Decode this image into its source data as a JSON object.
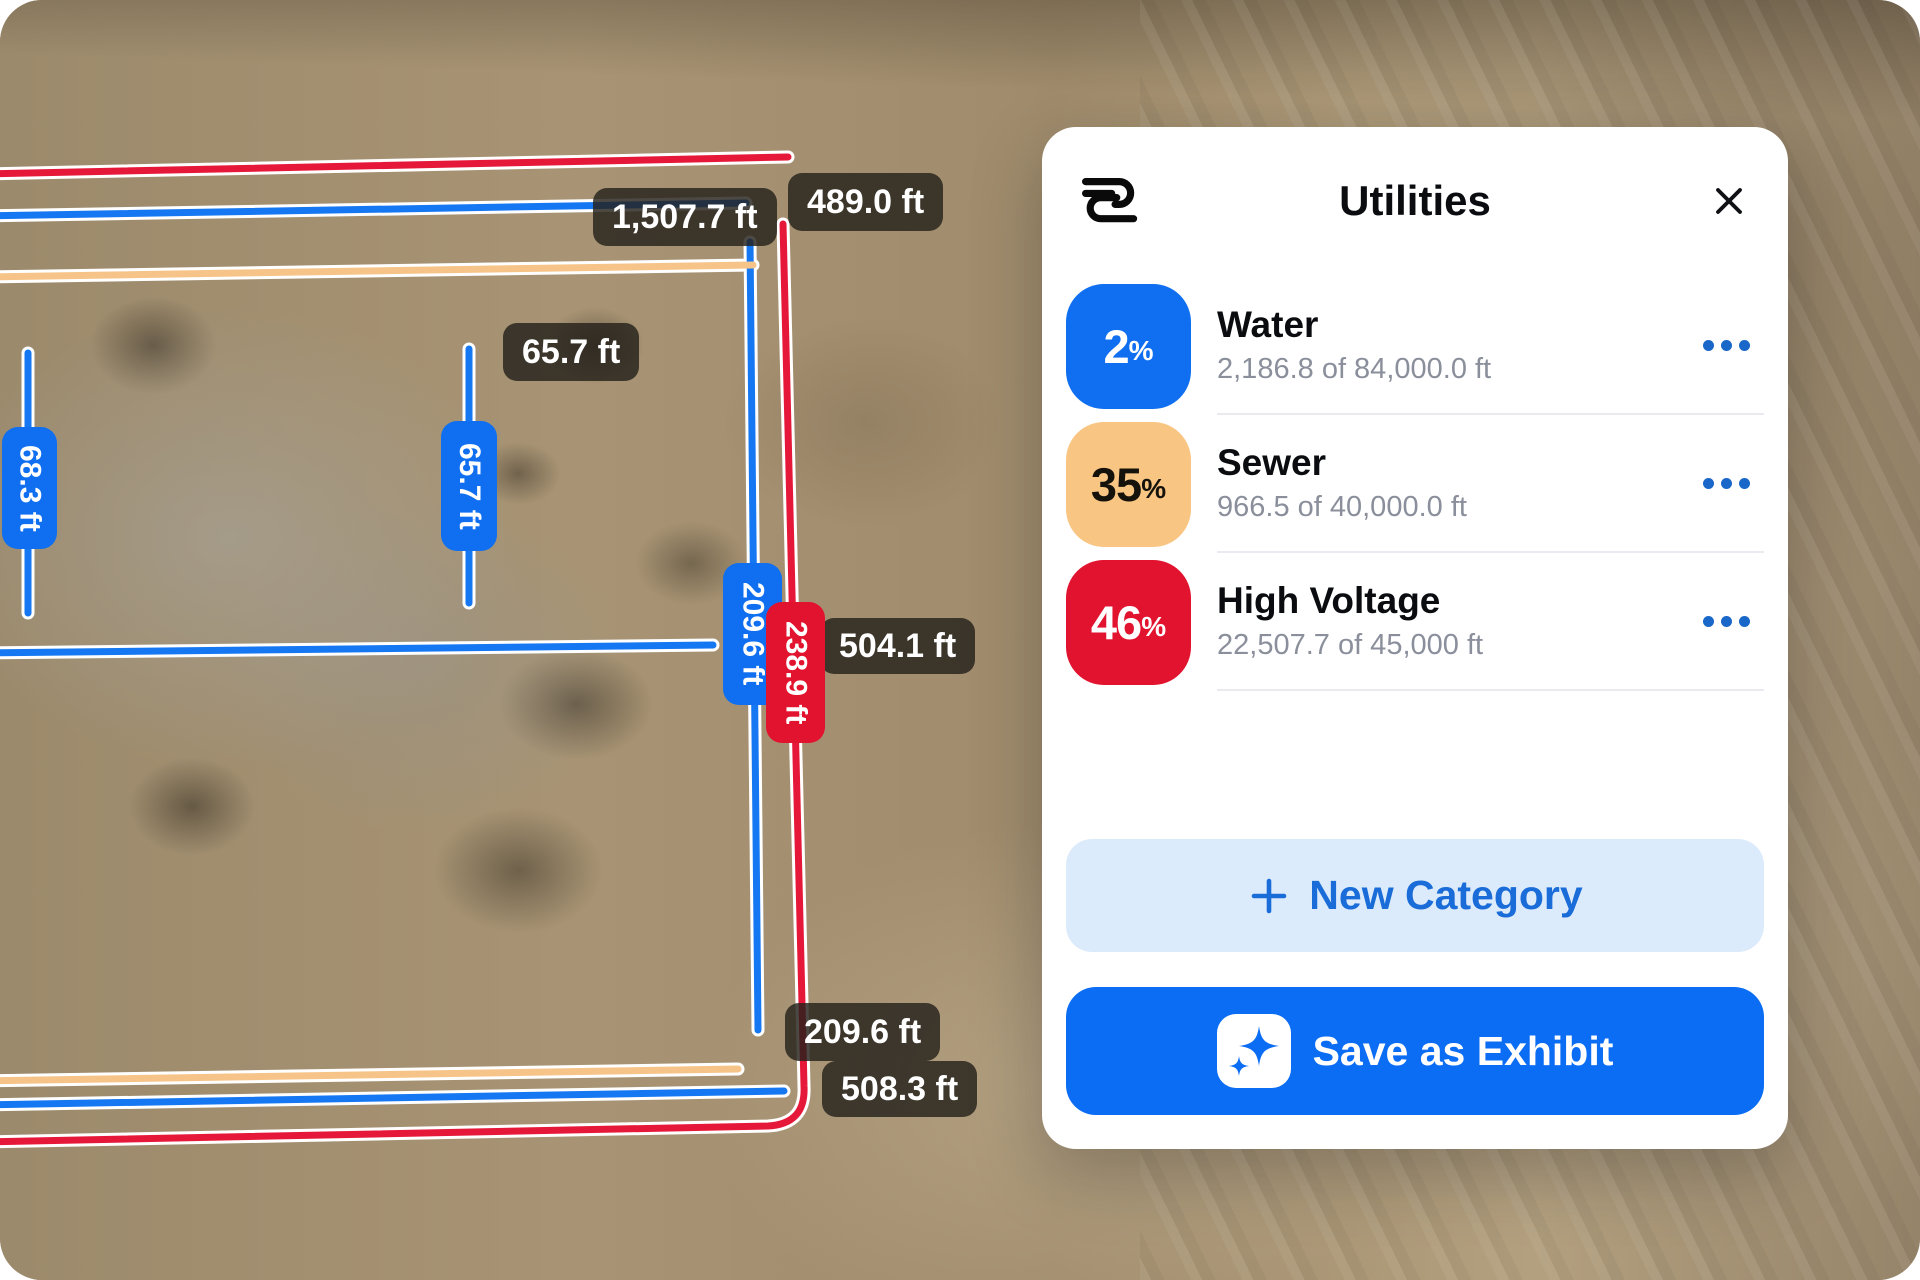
{
  "panel": {
    "title": "Utilities",
    "categories": [
      {
        "name": "Water",
        "percent": "2",
        "percent_symbol": "%",
        "detail": "2,186.8 of 84,000.0 ft",
        "badge_style": "background:#0f6ff0;color:#ffffff"
      },
      {
        "name": "Sewer",
        "percent": "35",
        "percent_symbol": "%",
        "detail": "966.5 of 40,000.0 ft",
        "badge_style": "background:#f9c583;color:#15120c"
      },
      {
        "name": "High Voltage",
        "percent": "46",
        "percent_symbol": "%",
        "detail": "22,507.7 of 45,000 ft",
        "badge_style": "background:#e2132f;color:#ffffff"
      }
    ],
    "new_category_label": "New Category",
    "save_label": "Save as Exhibit"
  },
  "map": {
    "labels": {
      "top_blue_length": "1,507.7 ft",
      "top_red_length": "489.0 ft",
      "pad_width": "65.7 ft",
      "pad_width_vertical": "65.7 ft",
      "left_height_vertical": "68.3 ft",
      "right_blue_vertical": "209.6 ft",
      "right_red_vertical": "238.9 ft",
      "right_mid_length": "504.1 ft",
      "bottom_blue_length": "209.6 ft",
      "bottom_red_length": "508.3 ft"
    }
  },
  "colors": {
    "water_blue": "#0f6ff0",
    "sewer_orange": "#f9c583",
    "high_voltage_red": "#e2132f",
    "save_button_blue": "#0b6cf4",
    "new_category_bg": "#dcebfb",
    "new_category_text": "#1a6cd8",
    "measure_label_bg": "rgba(37,33,27,0.82)"
  }
}
